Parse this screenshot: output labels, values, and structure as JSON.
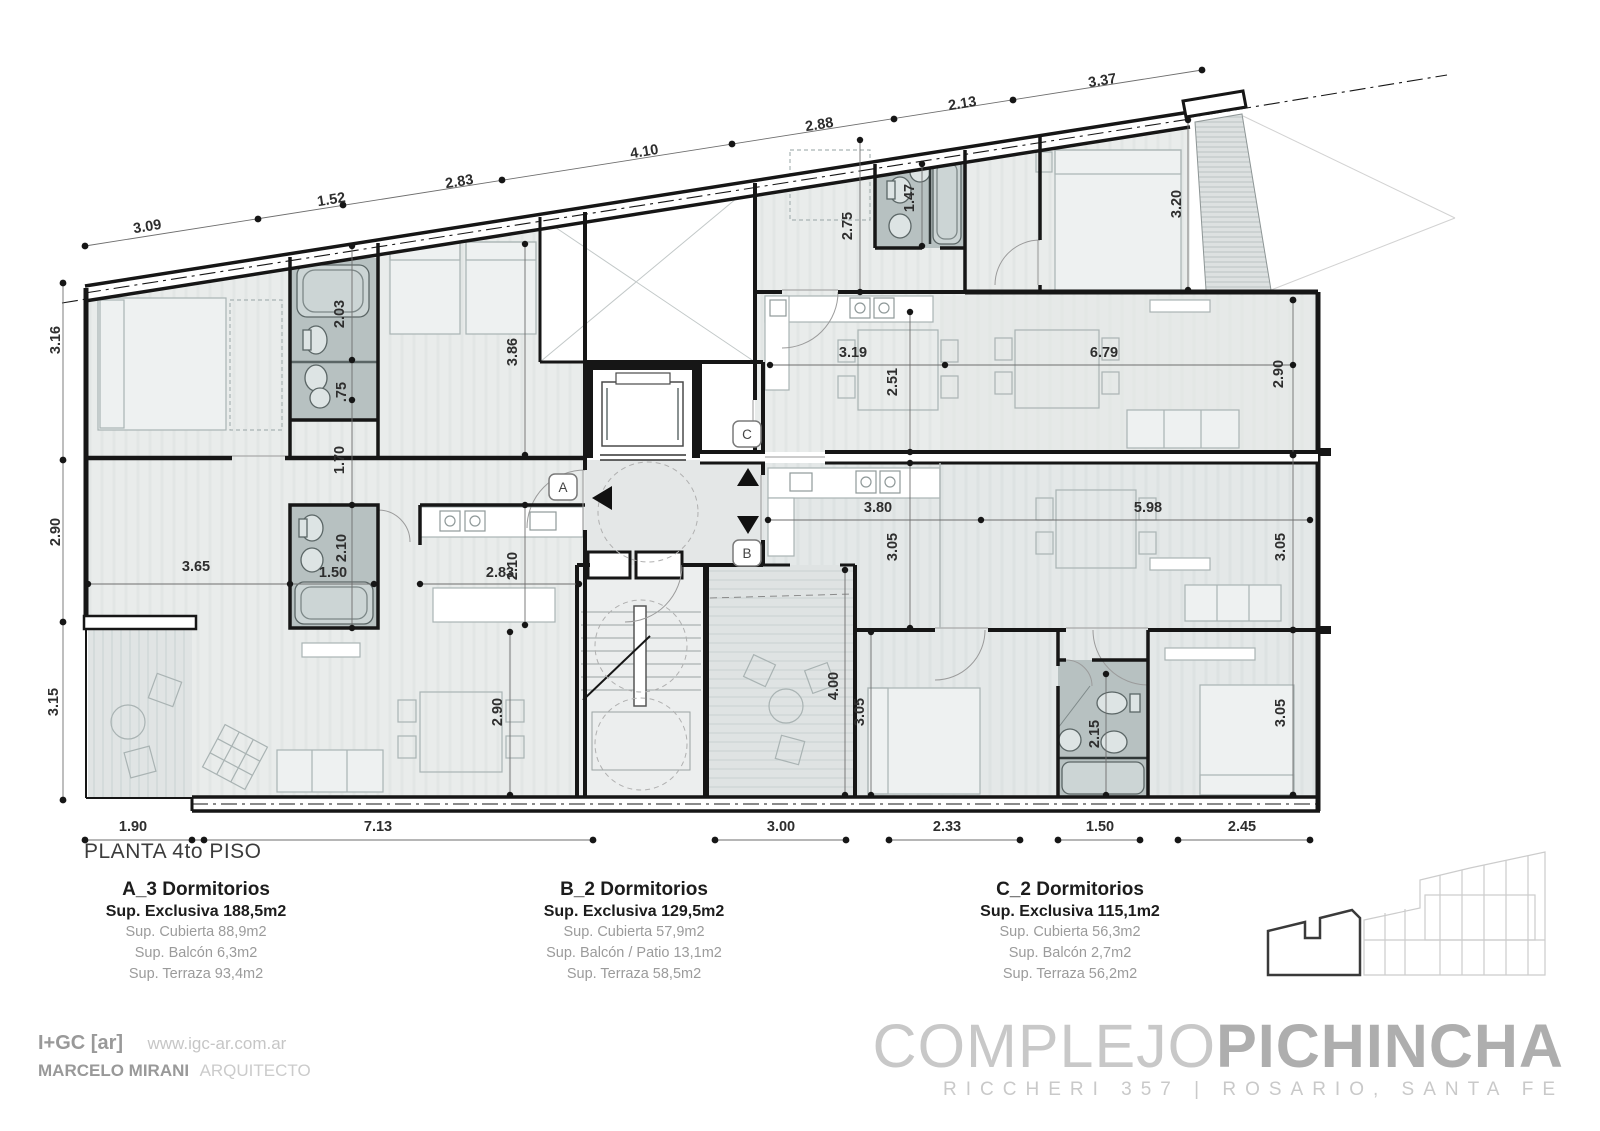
{
  "plan": {
    "title": "PLANTA 4to PISO",
    "markers": [
      {
        "label": "A"
      },
      {
        "label": "B"
      },
      {
        "label": "C"
      }
    ],
    "colors": {
      "wall": "#161616",
      "room": "#e9eceb",
      "wet_area": "#b7c1c1",
      "logo_gray": "#b2b2b2"
    },
    "symbols": [
      "elevator-up-arrow",
      "elevator-down-arrow",
      "entry-left-arrow",
      "unit-marker"
    ],
    "dimensions": [
      {
        "t": "3.09",
        "x": 148,
        "y": 231,
        "r": -9
      },
      {
        "t": "1.52",
        "x": 332,
        "y": 204,
        "r": -9
      },
      {
        "t": "2.83",
        "x": 460,
        "y": 186,
        "r": -9
      },
      {
        "t": "4.10",
        "x": 645,
        "y": 156,
        "r": -9
      },
      {
        "t": "2.88",
        "x": 820,
        "y": 129,
        "r": -9
      },
      {
        "t": "2.13",
        "x": 963,
        "y": 108,
        "r": -9
      },
      {
        "t": "3.37",
        "x": 1103,
        "y": 85,
        "r": -9
      },
      {
        "t": "3.16",
        "x": 60,
        "y": 340,
        "r": -90
      },
      {
        "t": "2.90",
        "x": 60,
        "y": 532,
        "r": -90
      },
      {
        "t": "3.15",
        "x": 58,
        "y": 702,
        "r": -90
      },
      {
        "t": "2.03",
        "x": 344,
        "y": 314,
        "r": -90
      },
      {
        "t": ".75",
        "x": 346,
        "y": 392,
        "r": -90
      },
      {
        "t": "1.70",
        "x": 344,
        "y": 460,
        "r": -90
      },
      {
        "t": "2.10",
        "x": 346,
        "y": 548,
        "r": -90
      },
      {
        "t": "1.50",
        "x": 333,
        "y": 577,
        "r": 0
      },
      {
        "t": "3.65",
        "x": 196,
        "y": 571,
        "r": 0
      },
      {
        "t": "2.83",
        "x": 500,
        "y": 577,
        "r": 0
      },
      {
        "t": "2.10",
        "x": 517,
        "y": 566,
        "r": -90
      },
      {
        "t": "3.86",
        "x": 517,
        "y": 352,
        "r": -90
      },
      {
        "t": "2.90",
        "x": 502,
        "y": 712,
        "r": -90
      },
      {
        "t": "2.75",
        "x": 852,
        "y": 226,
        "r": -90
      },
      {
        "t": "1.47",
        "x": 914,
        "y": 198,
        "r": -90
      },
      {
        "t": "3.19",
        "x": 853,
        "y": 357,
        "r": 0
      },
      {
        "t": "2.51",
        "x": 897,
        "y": 382,
        "r": -90
      },
      {
        "t": "6.79",
        "x": 1104,
        "y": 357,
        "r": 0
      },
      {
        "t": "2.90",
        "x": 1283,
        "y": 374,
        "r": -90
      },
      {
        "t": "3.20",
        "x": 1181,
        "y": 204,
        "r": -90
      },
      {
        "t": "3.80",
        "x": 878,
        "y": 512,
        "r": 0
      },
      {
        "t": "5.98",
        "x": 1148,
        "y": 512,
        "r": 0
      },
      {
        "t": "3.05",
        "x": 897,
        "y": 547,
        "r": -90
      },
      {
        "t": "3.05",
        "x": 1285,
        "y": 547,
        "r": -90
      },
      {
        "t": "4.00",
        "x": 838,
        "y": 686,
        "r": -90
      },
      {
        "t": "3.05",
        "x": 864,
        "y": 712,
        "r": -90
      },
      {
        "t": "2.15",
        "x": 1099,
        "y": 734,
        "r": -90
      },
      {
        "t": "3.05",
        "x": 1285,
        "y": 713,
        "r": -90
      },
      {
        "t": "1.90",
        "x": 133,
        "y": 831,
        "r": 0
      },
      {
        "t": "7.13",
        "x": 378,
        "y": 831,
        "r": 0
      },
      {
        "t": "3.00",
        "x": 781,
        "y": 831,
        "r": 0
      },
      {
        "t": "2.33",
        "x": 947,
        "y": 831,
        "r": 0
      },
      {
        "t": "1.50",
        "x": 1100,
        "y": 831,
        "r": 0
      },
      {
        "t": "2.45",
        "x": 1242,
        "y": 831,
        "r": 0
      }
    ]
  },
  "legend": {
    "units": [
      {
        "name": "A_3 Dormitorios",
        "exclusive": "Sup. Exclusiva 188,5m2",
        "details": [
          "Sup. Cubierta 88,9m2",
          "Sup. Balcón 6,3m2",
          "Sup. Terraza 93,4m2"
        ]
      },
      {
        "name": "B_2 Dormitorios",
        "exclusive": "Sup. Exclusiva 129,5m2",
        "details": [
          "Sup. Cubierta 57,9m2",
          "Sup. Balcón / Patio 13,1m2",
          "Sup. Terraza 58,5m2"
        ]
      },
      {
        "name": "C_2 Dormitorios",
        "exclusive": "Sup. Exclusiva 115,1m2",
        "details": [
          "Sup. Cubierta 56,3m2",
          "Sup. Balcón 2,7m2",
          "Sup. Terraza 56,2m2"
        ]
      }
    ]
  },
  "footer": {
    "firm": "I+GC [ar]",
    "website": "www.igc-ar.com.ar",
    "architect": "MARCELO MIRANI",
    "architect_title": "ARQUITECTO",
    "project_light": "COMPLEJO",
    "project_bold": "PICHINCHA",
    "address": "RICCHERI 357",
    "separator": "|",
    "city": "ROSARIO, SANTA FE"
  }
}
